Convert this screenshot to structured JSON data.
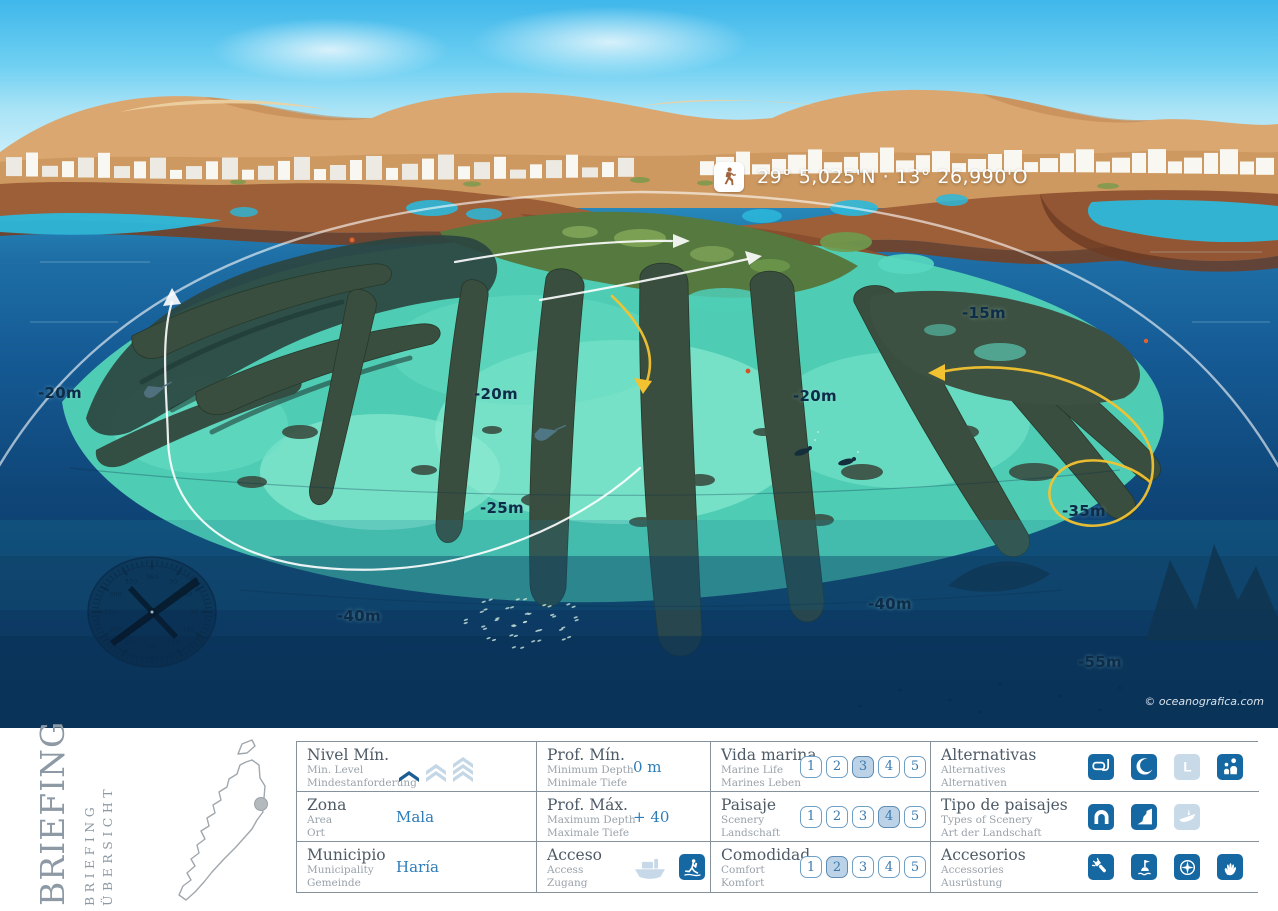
{
  "map": {
    "coordinates": "29° 5,025'N  ·  13° 26,990'O",
    "credit": "© oceanografica.com",
    "depth_labels": [
      {
        "text": "-20m",
        "x": 38,
        "y": 384
      },
      {
        "text": "-20m",
        "x": 474,
        "y": 385
      },
      {
        "text": "-20m",
        "x": 793,
        "y": 387
      },
      {
        "text": "-15m",
        "x": 962,
        "y": 304
      },
      {
        "text": "-25m",
        "x": 480,
        "y": 499
      },
      {
        "text": "-35m",
        "x": 1062,
        "y": 502
      },
      {
        "text": "-40m",
        "x": 337,
        "y": 607
      },
      {
        "text": "-40m",
        "x": 868,
        "y": 595
      },
      {
        "text": "-55m",
        "x": 1078,
        "y": 653
      }
    ],
    "compass_numerals": [
      "360",
      "30",
      "60",
      "90",
      "120",
      "150",
      "180",
      "210",
      "240",
      "270",
      "300",
      "330"
    ]
  },
  "panel": {
    "title": "BRIEFING",
    "subtitle_en": "BRIEFING",
    "subtitle_de": "ÜBERSICHT"
  },
  "colors": {
    "accent_blue": "#2E7CB8",
    "icon_active": "#1668A2",
    "icon_inactive": "#C8D9E8",
    "chip_selected": "#BCD3E7",
    "route_yellow": "#F2C230",
    "route_white": "#FFFFFF"
  },
  "table": {
    "rows": [
      [
        {
          "key": "nivel-min",
          "type": "level",
          "label": "Nivel Mín.",
          "sub1": "Min. Level",
          "sub2": "Mindestanforderung",
          "level": 1,
          "levels": 3
        },
        {
          "key": "prof-min",
          "type": "value",
          "label": "Prof. Mín.",
          "sub1": "Minimum Depth",
          "sub2": "Minimale Tiefe",
          "value": "0 m"
        },
        {
          "key": "vida-marina",
          "type": "rating",
          "label": "Vida marina",
          "sub1": "Marine Life",
          "sub2": "Marines Leben",
          "rating": 3,
          "scale": 5
        },
        {
          "key": "alternativas",
          "type": "icons",
          "label": "Alternativas",
          "sub1": "Alternatives",
          "sub2": "Alternativen",
          "icons": [
            {
              "name": "snorkel-icon",
              "active": true
            },
            {
              "name": "night-dive-icon",
              "active": true
            },
            {
              "name": "learner-icon",
              "active": false
            },
            {
              "name": "family-icon",
              "active": true
            }
          ]
        }
      ],
      [
        {
          "key": "zona",
          "type": "value",
          "label": "Zona",
          "sub1": "Area",
          "sub2": "Ort",
          "value": "Mala"
        },
        {
          "key": "prof-max",
          "type": "value",
          "label": "Prof. Máx.",
          "sub1": "Maximum Depth",
          "sub2": "Maximale Tiefe",
          "value": "+ 40"
        },
        {
          "key": "paisaje",
          "type": "rating",
          "label": "Paisaje",
          "sub1": "Scenery",
          "sub2": "Landschaft",
          "rating": 4,
          "scale": 5
        },
        {
          "key": "tipo-de-paisajes",
          "type": "icons",
          "label": "Tipo de paisajes",
          "sub1": "Types of Scenery",
          "sub2": "Art der Landschaft",
          "icons": [
            {
              "name": "arch-icon",
              "active": true
            },
            {
              "name": "wall-icon",
              "active": true
            },
            {
              "name": "wreck-icon",
              "active": false
            }
          ]
        }
      ],
      [
        {
          "key": "municipio",
          "type": "value",
          "label": "Municipio",
          "sub1": "Municipality",
          "sub2": "Gemeinde",
          "value": "Haría"
        },
        {
          "key": "acceso",
          "type": "icons",
          "label": "Acceso",
          "sub1": "Access",
          "sub2": "Zugang",
          "icons": [
            {
              "name": "boat-icon",
              "active": false,
              "bare": true
            },
            {
              "name": "shore-entry-icon",
              "active": true
            }
          ]
        },
        {
          "key": "comodidad",
          "type": "rating",
          "label": "Comodidad",
          "sub1": "Comfort",
          "sub2": "Komfort",
          "rating": 2,
          "scale": 5
        },
        {
          "key": "accesorios",
          "type": "icons",
          "label": "Accesorios",
          "sub1": "Accessories",
          "sub2": "Ausrüstung",
          "icons": [
            {
              "name": "torch-icon",
              "active": true
            },
            {
              "name": "marker-buoy-icon",
              "active": true
            },
            {
              "name": "compass-icon",
              "active": true
            },
            {
              "name": "gloves-icon",
              "active": true
            }
          ]
        }
      ]
    ]
  }
}
